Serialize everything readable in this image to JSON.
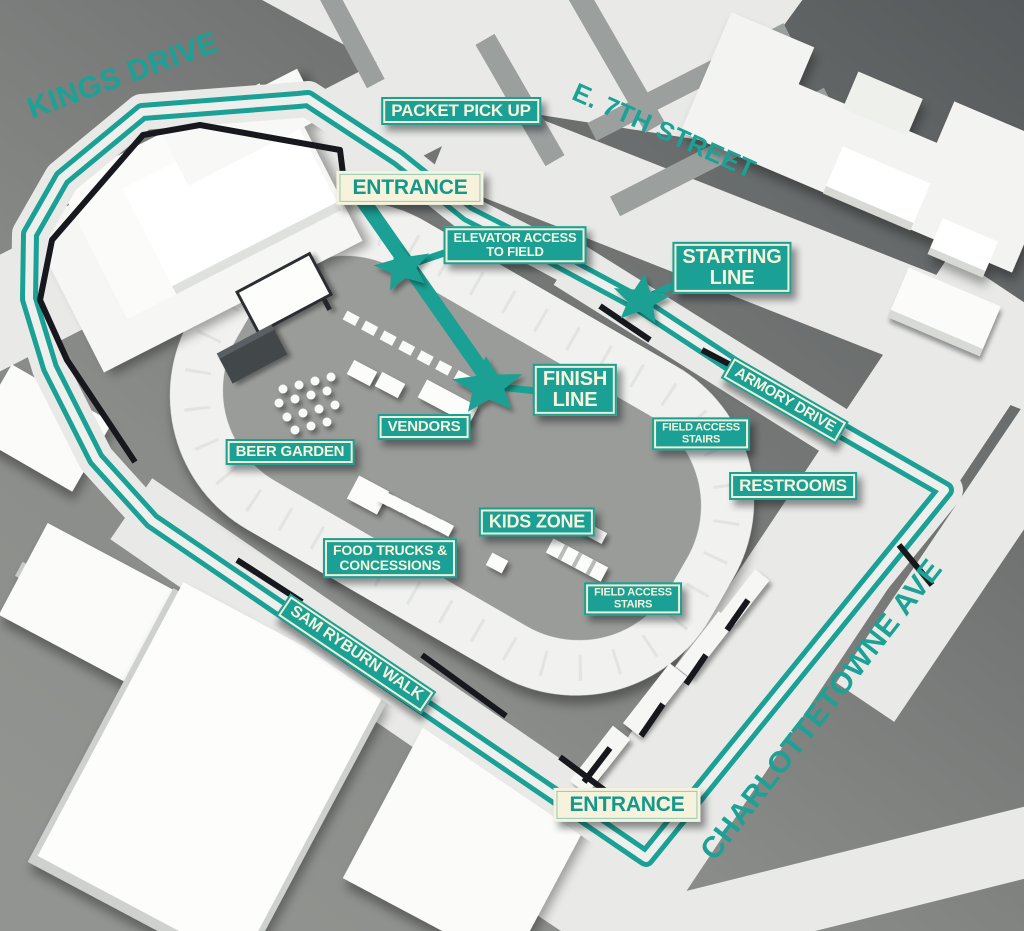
{
  "map": {
    "title": "race event site map",
    "colors": {
      "course_teal": "#1aa094",
      "badge_cream": "#f6f2dc",
      "street_light": "#e9eae7",
      "background_dark": "#585b5d",
      "background_light": "#919390",
      "fence_black": "#17181e",
      "field_gray": "#9a9c99"
    },
    "streets": {
      "kings_drive": "KINGS DRIVE",
      "e_7th_street": "E. 7TH STREET",
      "charlottetowne_ave": "CHARLOTTETOWNE AVE",
      "armory_drive": "ARMORY DRIVE",
      "sam_ryburn_walk": "SAM RYBURN WALK"
    },
    "badges": {
      "packet_pickup": "PACKET PICK UP",
      "entrance_top": "ENTRANCE",
      "elevator_access": "ELEVATOR ACCESS\nTO FIELD",
      "starting_line": "STARTING\nLINE",
      "finish_line": "FINISH\nLINE",
      "vendors": "VENDORS",
      "beer_garden": "BEER GARDEN",
      "field_access_stairs_north": "FIELD ACCESS\nSTAIRS",
      "restrooms": "RESTROOMS",
      "kids_zone": "KIDS ZONE",
      "food_trucks": "FOOD TRUCKS &\nCONCESSIONS",
      "field_access_stairs_south": "FIELD ACCESS\nSTAIRS",
      "entrance_bottom": "ENTRANCE"
    },
    "markers": {
      "elevator_star": "course star at elevator access",
      "starting_line_star": "course star at starting line",
      "finish_line_star": "course star at finish line"
    }
  }
}
